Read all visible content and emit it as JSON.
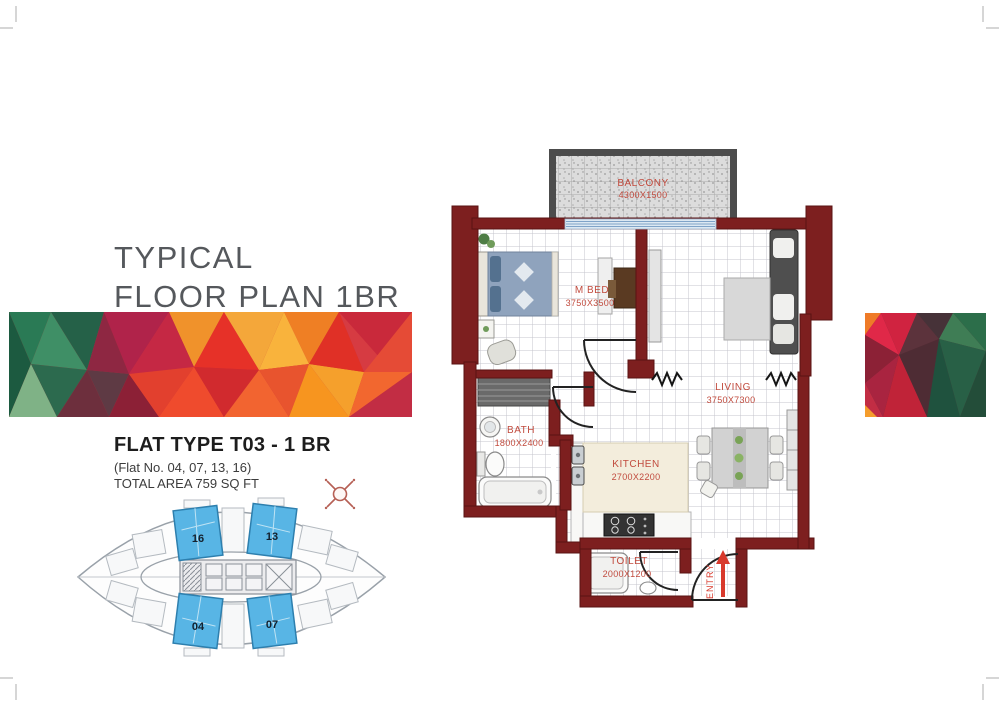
{
  "header": {
    "title_line1": "TYPICAL",
    "title_line2": "FLOOR PLAN 1BR"
  },
  "flat_info": {
    "type": "FLAT TYPE T03 - 1 BR",
    "numbers": "(Flat No. 04, 07, 13, 16)",
    "area": "TOTAL AREA 759 SQ FT"
  },
  "floor_plan": {
    "rooms": [
      {
        "name": "BALCONY",
        "dims": "4300X1500"
      },
      {
        "name": "M BED",
        "dims": "3750X3500"
      },
      {
        "name": "LIVING",
        "dims": "3750X7300"
      },
      {
        "name": "BATH",
        "dims": "1800X2400"
      },
      {
        "name": "KITCHEN",
        "dims": "2700X2200"
      },
      {
        "name": "TOILET",
        "dims": "2000X1200"
      }
    ],
    "entry_label": "ENTRY"
  },
  "key_plan": {
    "highlighted_units": [
      "16",
      "13",
      "04",
      "07"
    ]
  },
  "colors": {
    "wall_maroon": "#7d1f1f",
    "label_red": "#c14b3e",
    "entry_red": "#d8392c",
    "unit_blue": "#58b5e5",
    "balcony_gray": "#d9d9d9",
    "banner_green": "#2a7a55",
    "banner_crimson": "#b0234a",
    "banner_orange": "#f0922b",
    "banner_red": "#e03026"
  }
}
